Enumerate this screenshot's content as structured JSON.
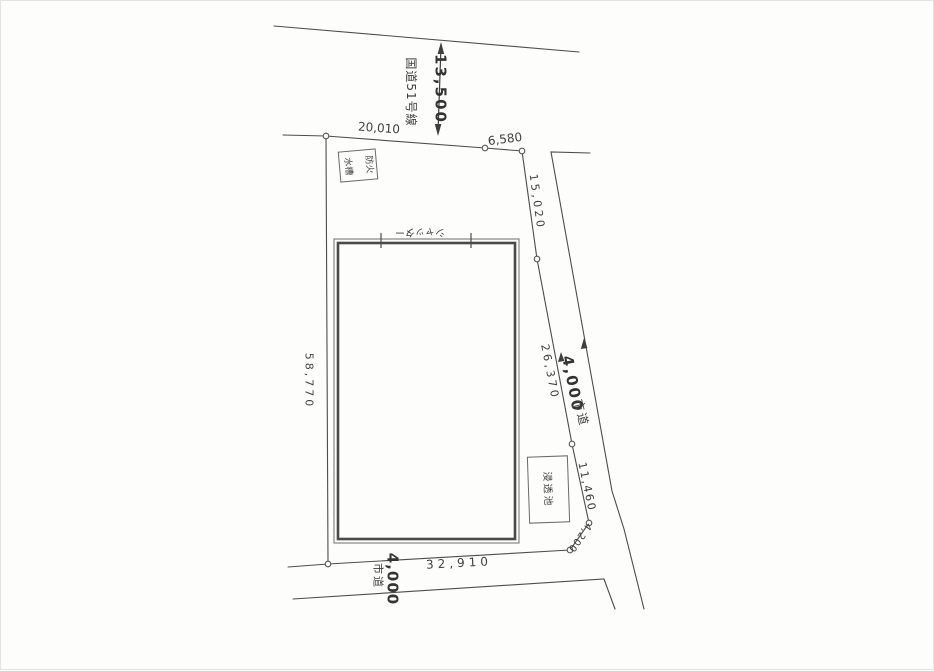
{
  "plan": {
    "national_route": {
      "name": "国道51号線",
      "width_dim": "13,500"
    },
    "city_road_right": {
      "name": "市道",
      "width_dim": "4,000"
    },
    "city_road_bottom": {
      "name": "市道",
      "width_dim": "4,000"
    },
    "boundary_dims": {
      "north_left": "20,010",
      "north_right": "6,580",
      "east_1": "15,020",
      "east_2": "26,370",
      "east_3": "11,460",
      "east_4": "4,200",
      "west": "58,770",
      "south": "32,910"
    },
    "building": {
      "shutter_label": "シャッター"
    },
    "structures": {
      "fire_water_tank_line1": "防火",
      "fire_water_tank_line2": "水槽",
      "infiltration_pond": "浸透池"
    },
    "colors": {
      "line": "#4d4d4d",
      "text": "#3f3f3f",
      "background": "#fdfdfc"
    }
  }
}
